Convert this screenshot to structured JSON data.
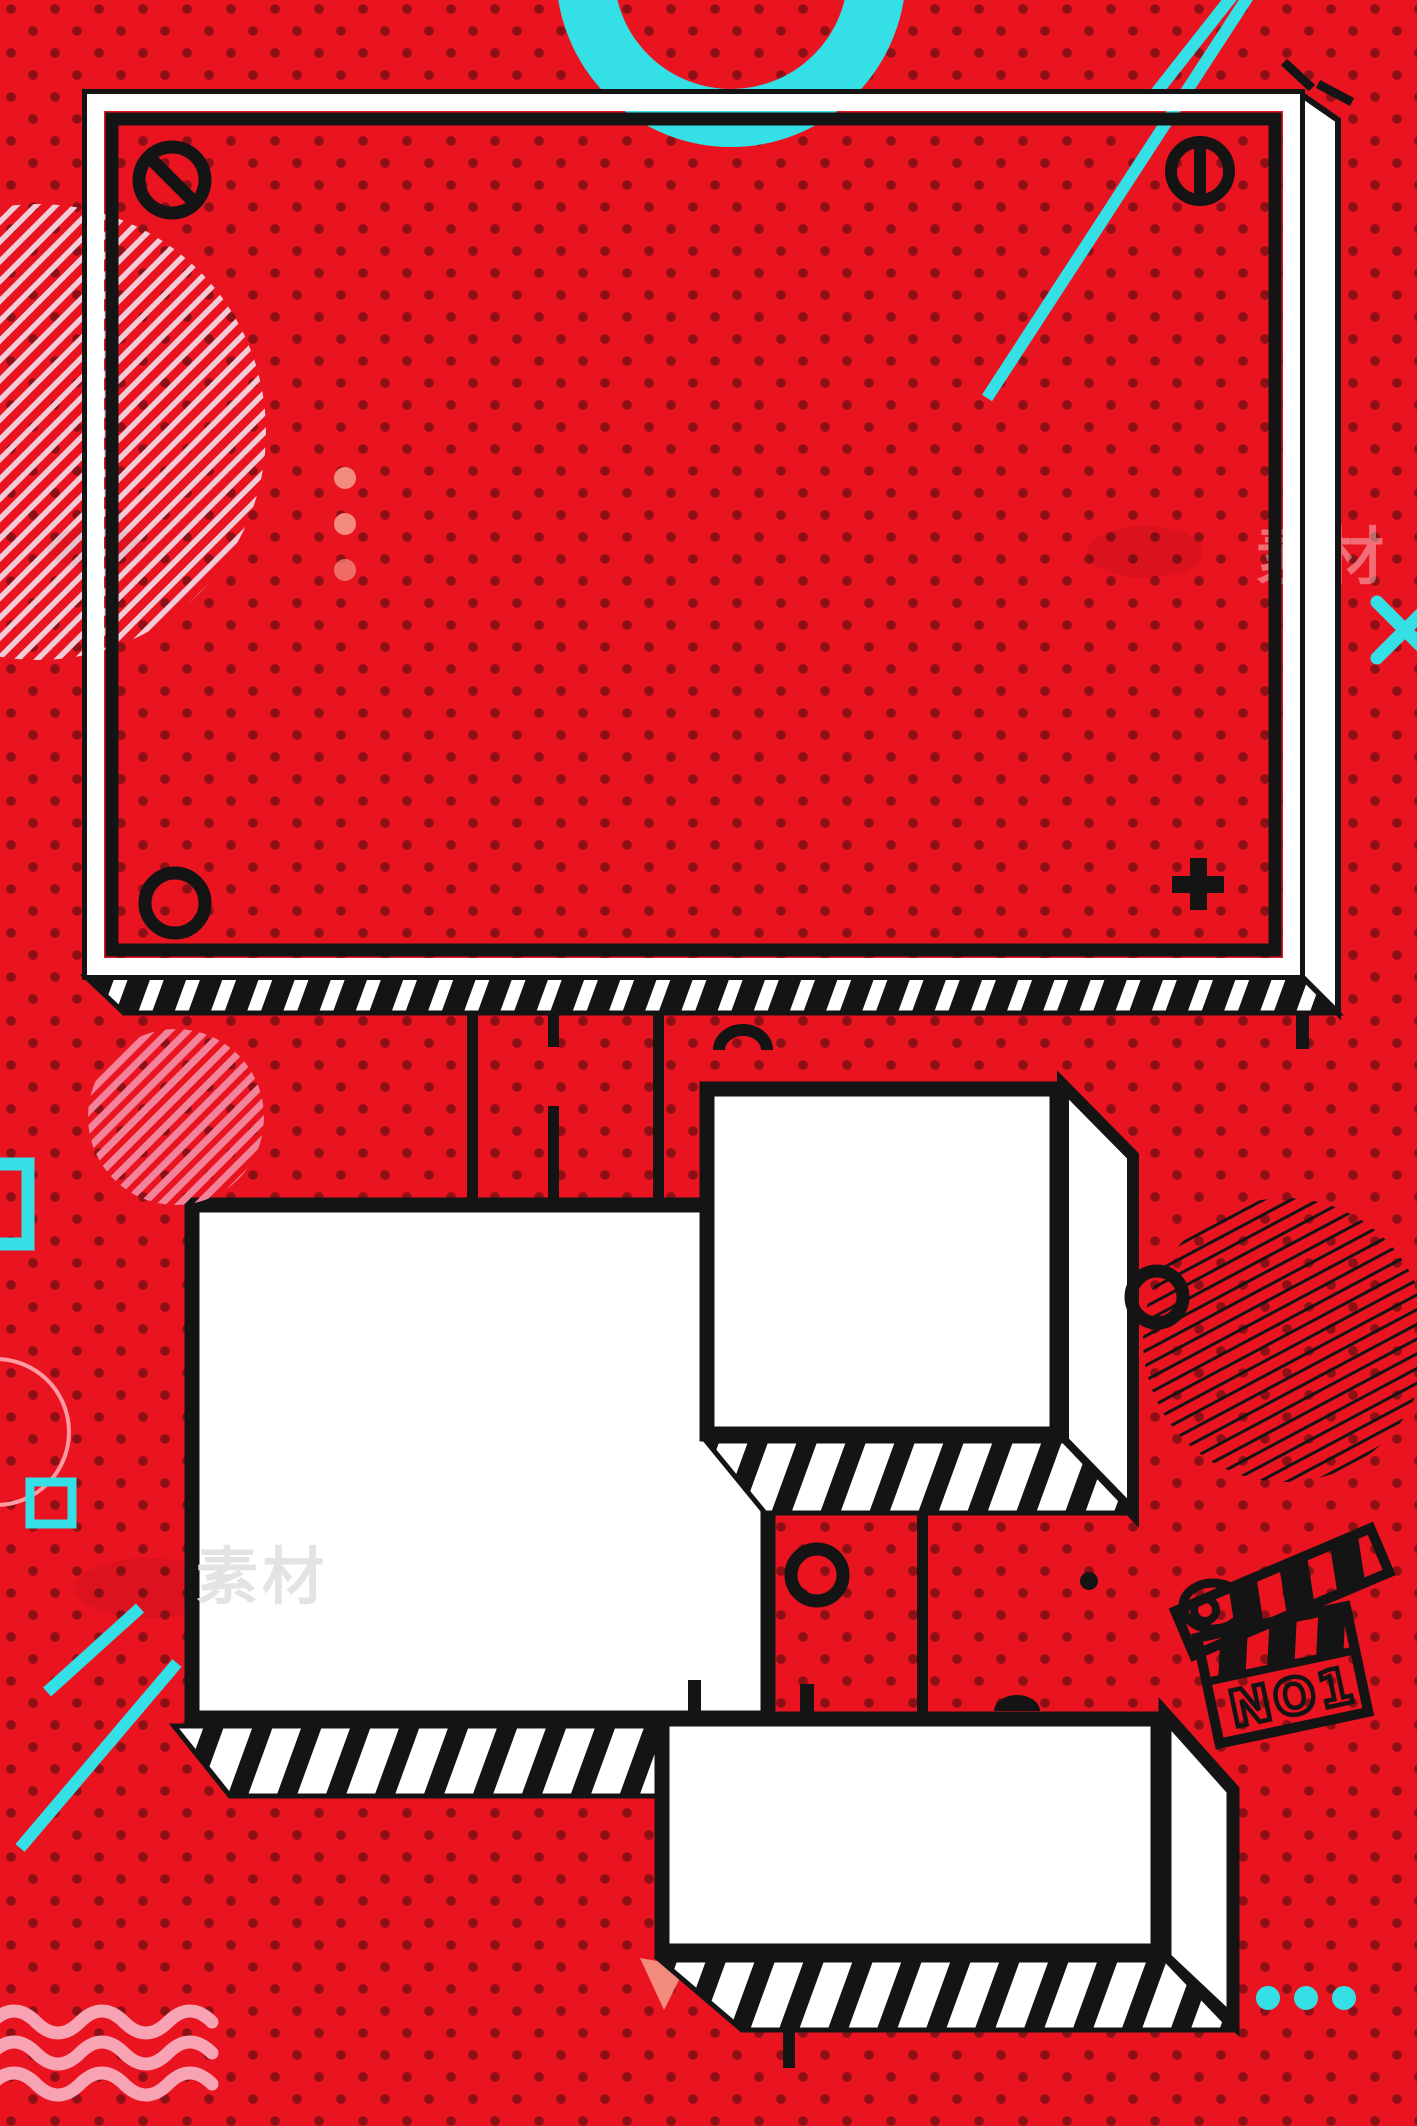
{
  "poster": {
    "description": "Red memphis pop-art poster background with empty white 3D frames and doodles",
    "texts": {
      "clapperboard_label": "NO1",
      "watermark_left": "素材",
      "watermark_right": "素材"
    },
    "colors": {
      "red": "#ea1420",
      "dot": "#8c1016",
      "ink": "#141414",
      "paper": "#ffffff",
      "cyan": "#35dfe6",
      "salmon": "#f28a7e",
      "pink": "#f2839a",
      "pink-light": "#f3ccd8",
      "pink-wave": "#f7a3b3",
      "pink-ring": "#ff9aa2",
      "watermark-gray": "#e3e3e3"
    },
    "decorations": [
      "polka-dot-background",
      "cyan-ring-arc-top",
      "cyan-diagonal-lines-top-right",
      "pink-hatched-circle-top-left",
      "pink-dots-column",
      "main-screen-frame-with-screws",
      "no-entry-screw",
      "slotted-screw",
      "plain-screw",
      "plus-screw",
      "hatched-3d-shadows",
      "connector-lines",
      "left-white-box",
      "middle-white-box",
      "bottom-white-box",
      "pink-hatched-circle-mid-left",
      "black-hatched-circle-right",
      "clapperboard-doodle",
      "cyan-squares-left",
      "pink-circle-outline-left",
      "cyan-diagonal-lines-bottom-left",
      "pink-wavy-lines",
      "cyan-x-right-edge",
      "cyan-dots-bottom-right"
    ]
  }
}
